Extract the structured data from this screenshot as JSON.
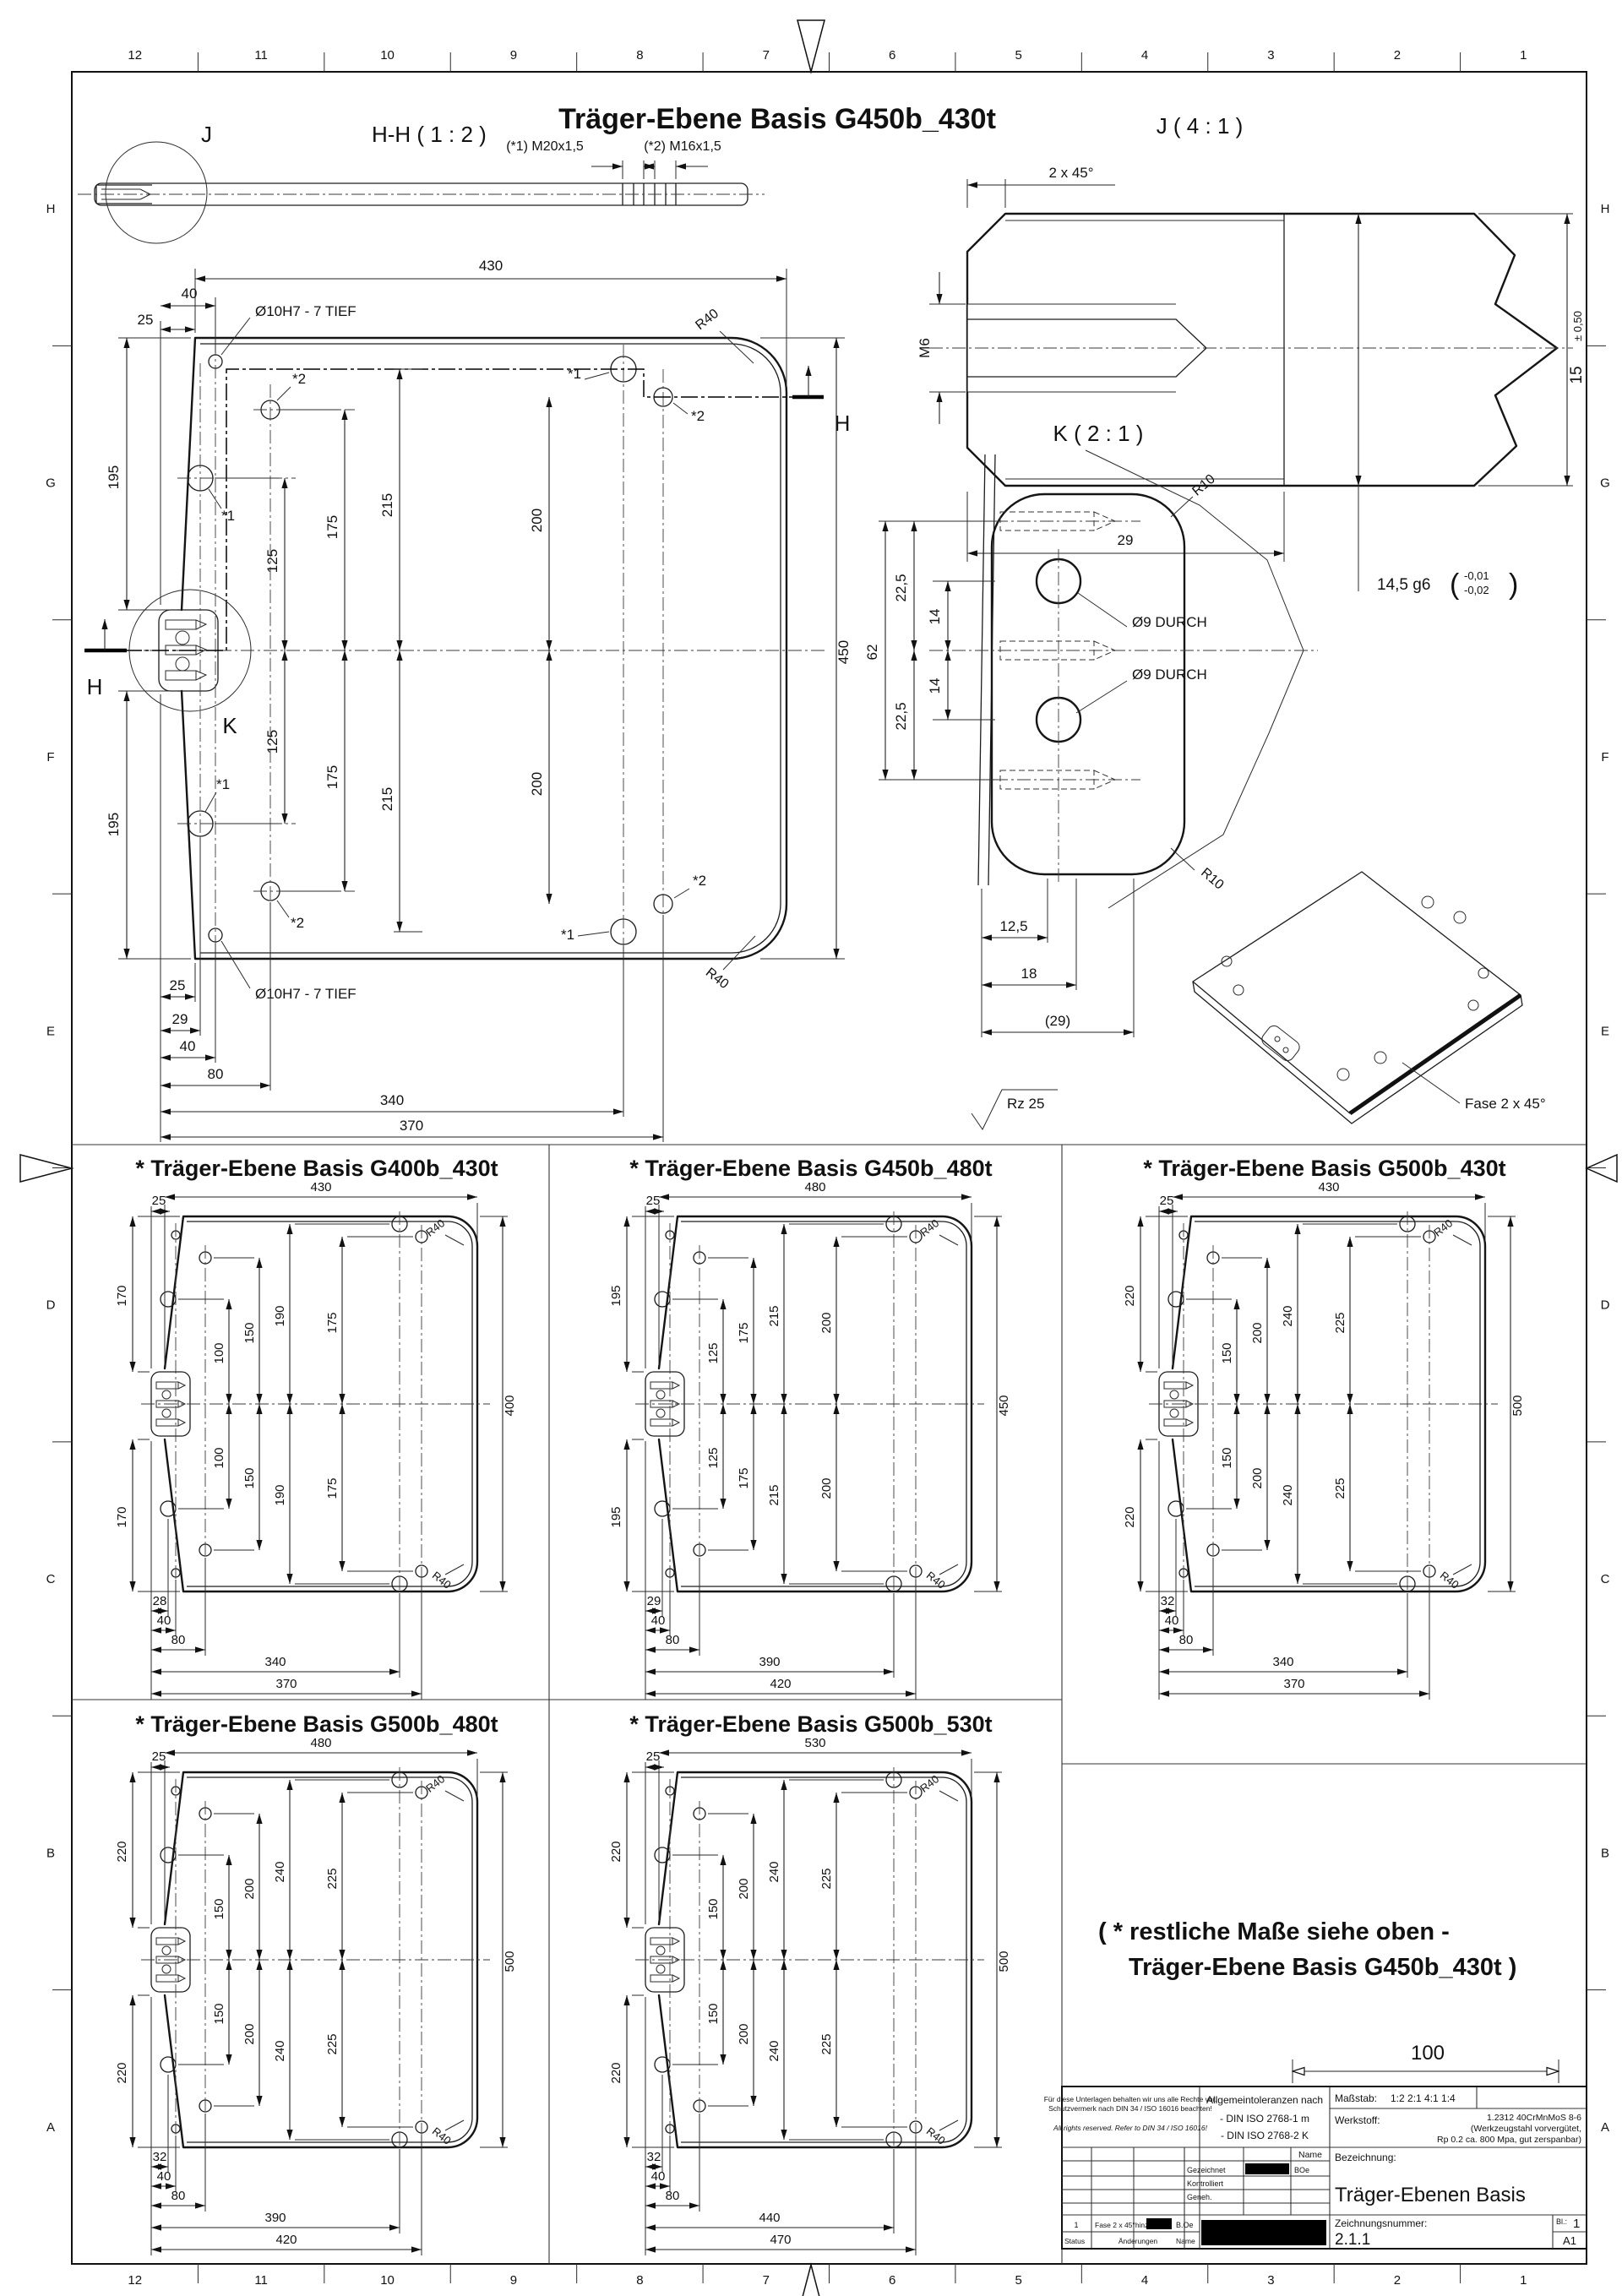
{
  "sheet": {
    "border": {
      "columns": [
        "12",
        "11",
        "10",
        "9",
        "8",
        "7",
        "6",
        "5",
        "4",
        "3",
        "2",
        "1"
      ],
      "rows": [
        "H",
        "G",
        "F",
        "E",
        "D",
        "C",
        "B",
        "A"
      ]
    },
    "main_title": "Träger-Ebene Basis G450b_430t"
  },
  "section_hh": {
    "title": "H-H ( 1 : 2 )",
    "detail_circle": "J",
    "callout_1": "(*1)  M20x1,5",
    "callout_2": "(*2)  M16x1,5"
  },
  "detail_j": {
    "title": "J ( 4 : 1 )",
    "chamfer": "2 x 45°",
    "thread": "M6",
    "length": "29",
    "fit": "14,5 g6",
    "paren_open": "(",
    "tol_upper": "-0,01",
    "tol_lower": "-0,02",
    "paren_close": ")",
    "dia": "15",
    "dia_tol": "± 0,50"
  },
  "main_view": {
    "width": "430",
    "d40": "40",
    "d25": "25",
    "hole_note_top": "Ø10H7 - 7 TIEF",
    "hole_note_bottom": "Ø10H7 - 7 TIEF",
    "left_upper": "195",
    "left_lower": "195",
    "height": "450",
    "radius_top": "R40",
    "radius_bottom": "R40",
    "v125a": "125",
    "v175a": "175",
    "v215a": "215",
    "v200a": "200",
    "v125b": "125",
    "v175b": "175",
    "v215b": "215",
    "v200b": "200",
    "b25": "25",
    "b29": "29",
    "b40": "40",
    "b80": "80",
    "b340": "340",
    "b370": "370",
    "star1": "*1",
    "star2": "*2",
    "h_label": "H",
    "k_label": "K"
  },
  "detail_k": {
    "title": "K ( 2 : 1 )",
    "r10_top": "R10",
    "r10_bottom": "R10",
    "hole_top": "Ø9 DURCH",
    "hole_bottom": "Ø9 DURCH",
    "d62": "62",
    "d225_upper": "22,5",
    "d225_lower": "22,5",
    "d14_upper": "14",
    "d14_lower": "14",
    "d125": "12,5",
    "d18": "18",
    "d29": "(29)"
  },
  "iso": {
    "chamfer_note": "Fase 2 x 45°"
  },
  "surface": {
    "roughness": "Rz 25"
  },
  "note": {
    "line1": "( * restliche Maße siehe oben -",
    "line2": "Träger-Ebene Basis G450b_430t )",
    "scale_value": "100"
  },
  "variants": [
    {
      "title": "* Träger-Ebene Basis G400b_430t",
      "top": "430",
      "d25": "25",
      "side": "170",
      "d0": "100",
      "d1": "150",
      "d2": "190",
      "d3": "175",
      "right": "400",
      "r40": "R40",
      "b1": "28",
      "b40": "40",
      "b80": "80",
      "b4": "340",
      "b5": "370"
    },
    {
      "title": "* Träger-Ebene Basis G450b_480t",
      "top": "480",
      "d25": "25",
      "side": "195",
      "d0": "125",
      "d1": "175",
      "d2": "215",
      "d3": "200",
      "right": "450",
      "r40": "R40",
      "b1": "29",
      "b40": "40",
      "b80": "80",
      "b4": "390",
      "b5": "420"
    },
    {
      "title": "* Träger-Ebene Basis G500b_430t",
      "top": "430",
      "d25": "25",
      "side": "220",
      "d0": "150",
      "d1": "200",
      "d2": "240",
      "d3": "225",
      "right": "500",
      "r40": "R40",
      "b1": "32",
      "b40": "40",
      "b80": "80",
      "b4": "340",
      "b5": "370"
    },
    {
      "title": "* Träger-Ebene Basis G500b_480t",
      "top": "480",
      "d25": "25",
      "side": "220",
      "d0": "150",
      "d1": "200",
      "d2": "240",
      "d3": "225",
      "right": "500",
      "r40": "R40",
      "b1": "32",
      "b40": "40",
      "b80": "80",
      "b4": "390",
      "b5": "420"
    },
    {
      "title": "* Träger-Ebene Basis G500b_530t",
      "top": "530",
      "d25": "25",
      "side": "220",
      "d0": "150",
      "d1": "200",
      "d2": "240",
      "d3": "225",
      "right": "500",
      "r40": "R40",
      "b1": "32",
      "b40": "40",
      "b80": "80",
      "b4": "440",
      "b5": "470"
    }
  ],
  "titleblock": {
    "disclaimer_de1": "Für diese Unterlagen behalten wir uns alle Rechte vor.",
    "disclaimer_de2": "Schutzvermerk nach DIN 34 / ISO 16016 beachten!",
    "disclaimer_en": "All rights reserved. Refer to DIN 34 / ISO 16016!",
    "tol_title": "Allgemeintoleranzen nach",
    "tol_line1": "- DIN ISO 2768-1 m",
    "tol_line2": "- DIN ISO 2768-2 K",
    "scale_label": "Maßstab:",
    "scale_values": "1:2   2:1   4:1   1:4",
    "material_label": "Werkstoff:",
    "material_line1": "1.2312 40CrMnMoS 8-6",
    "material_line2": "(Werkzeugstahl vorvergütet,",
    "material_line3": "Rp 0.2 ca. 800 Mpa, gut zerspanbar)",
    "name_header": "Name",
    "drawn_label": "Gezeichnet",
    "drawn_name": "BOe",
    "checked_label": "Kontrolliert",
    "approved_label": "Geneh.",
    "designation_label": "Bezeichnung:",
    "designation": "Träger-Ebenen Basis",
    "drawing_no_label": "Zeichnungsnummer:",
    "drawing_no": "2.1.1",
    "sheet_label": "Bl.:",
    "sheet_no": "1",
    "format": "A1",
    "rev_no": "1",
    "rev_text": "Fase 2 x 45°hinzu",
    "rev_name": "B.Oe",
    "status_label": "Status",
    "changes_label": "Änderungen",
    "name_label": "Name"
  }
}
